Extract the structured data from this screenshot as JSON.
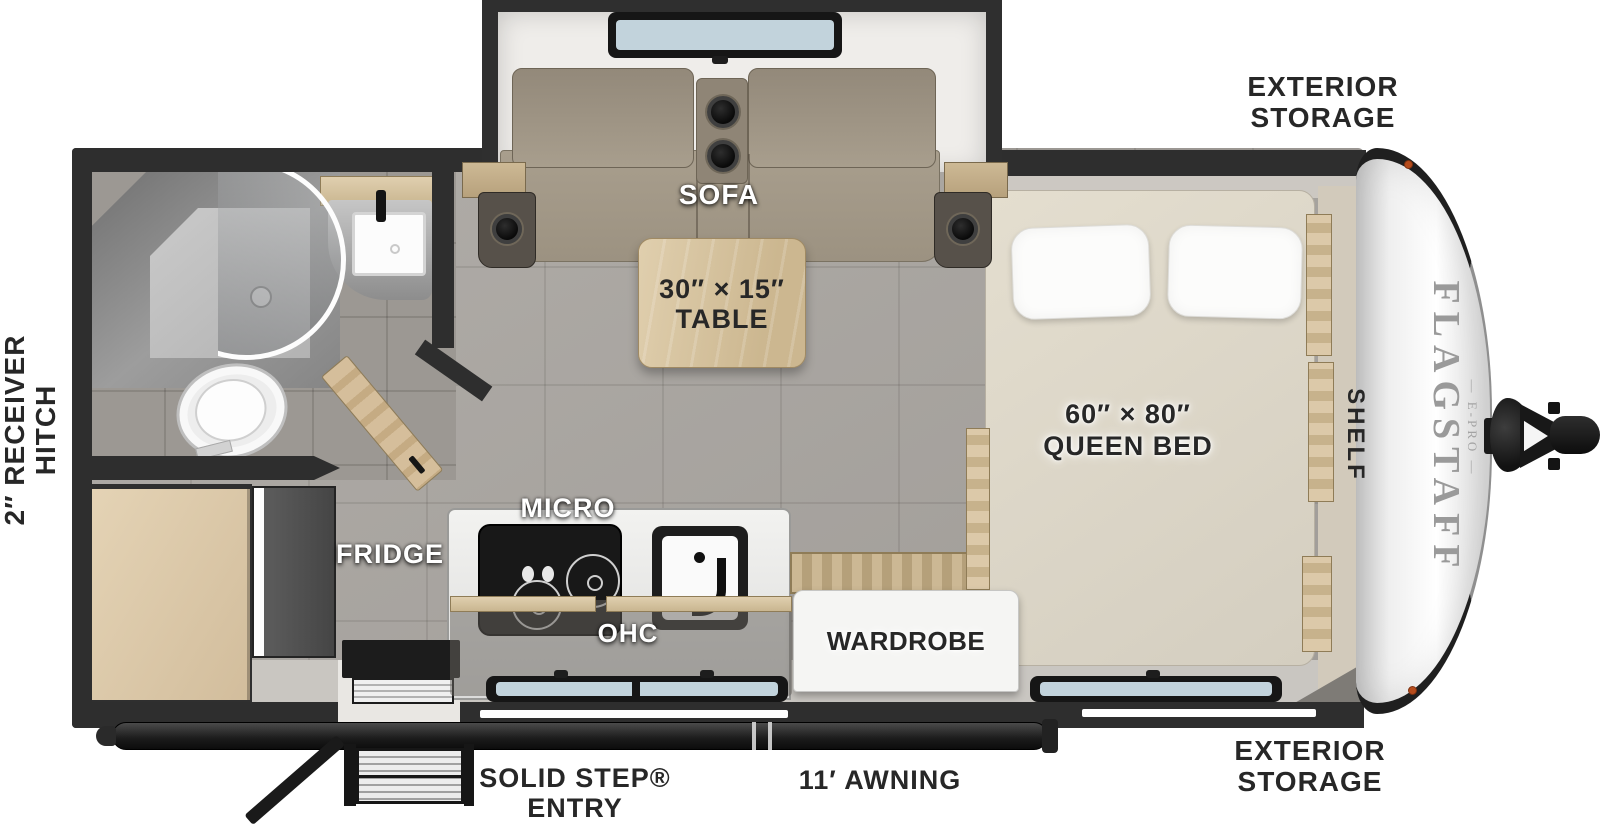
{
  "floorplan": {
    "exterior": {
      "storage_top": {
        "line1": "EXTERIOR",
        "line2": "STORAGE"
      },
      "storage_bottom": {
        "line1": "EXTERIOR",
        "line2": "STORAGE"
      },
      "receiver_hitch": {
        "line1": "2″ RECEIVER",
        "line2": "HITCH"
      },
      "awning": "11′ AWNING",
      "entry_step": {
        "line1": "SOLID STEP®",
        "line2": "ENTRY"
      }
    },
    "interior": {
      "sofa": "SOFA",
      "table": {
        "line1": "30″ × 15″",
        "line2": "TABLE"
      },
      "micro": "MICRO",
      "ohc": "OHC",
      "fridge": "FRIDGE",
      "wardrobe": "WARDROBE",
      "queen_bed": {
        "line1": "60″ × 80″",
        "line2": "QUEEN BED"
      },
      "shelf": "SHELF"
    },
    "brand": {
      "name": "FLAGSTAFF",
      "model": "— E-PRO —"
    }
  },
  "colors": {
    "wall": "#2e2e2e",
    "floor": "#aba7a2",
    "bath-floor": "#9c9893",
    "wood": "#d8c6a6",
    "sofa": "#a79d8c",
    "mattress": "#ded8cb",
    "counter": "#ededeb",
    "cap": "#f2f2f2",
    "label-dark": "#272727",
    "label-white": "#ffffff",
    "marker": "#b64c1c",
    "glass": "#c2d3dc",
    "awning": "#1f1f1f"
  }
}
